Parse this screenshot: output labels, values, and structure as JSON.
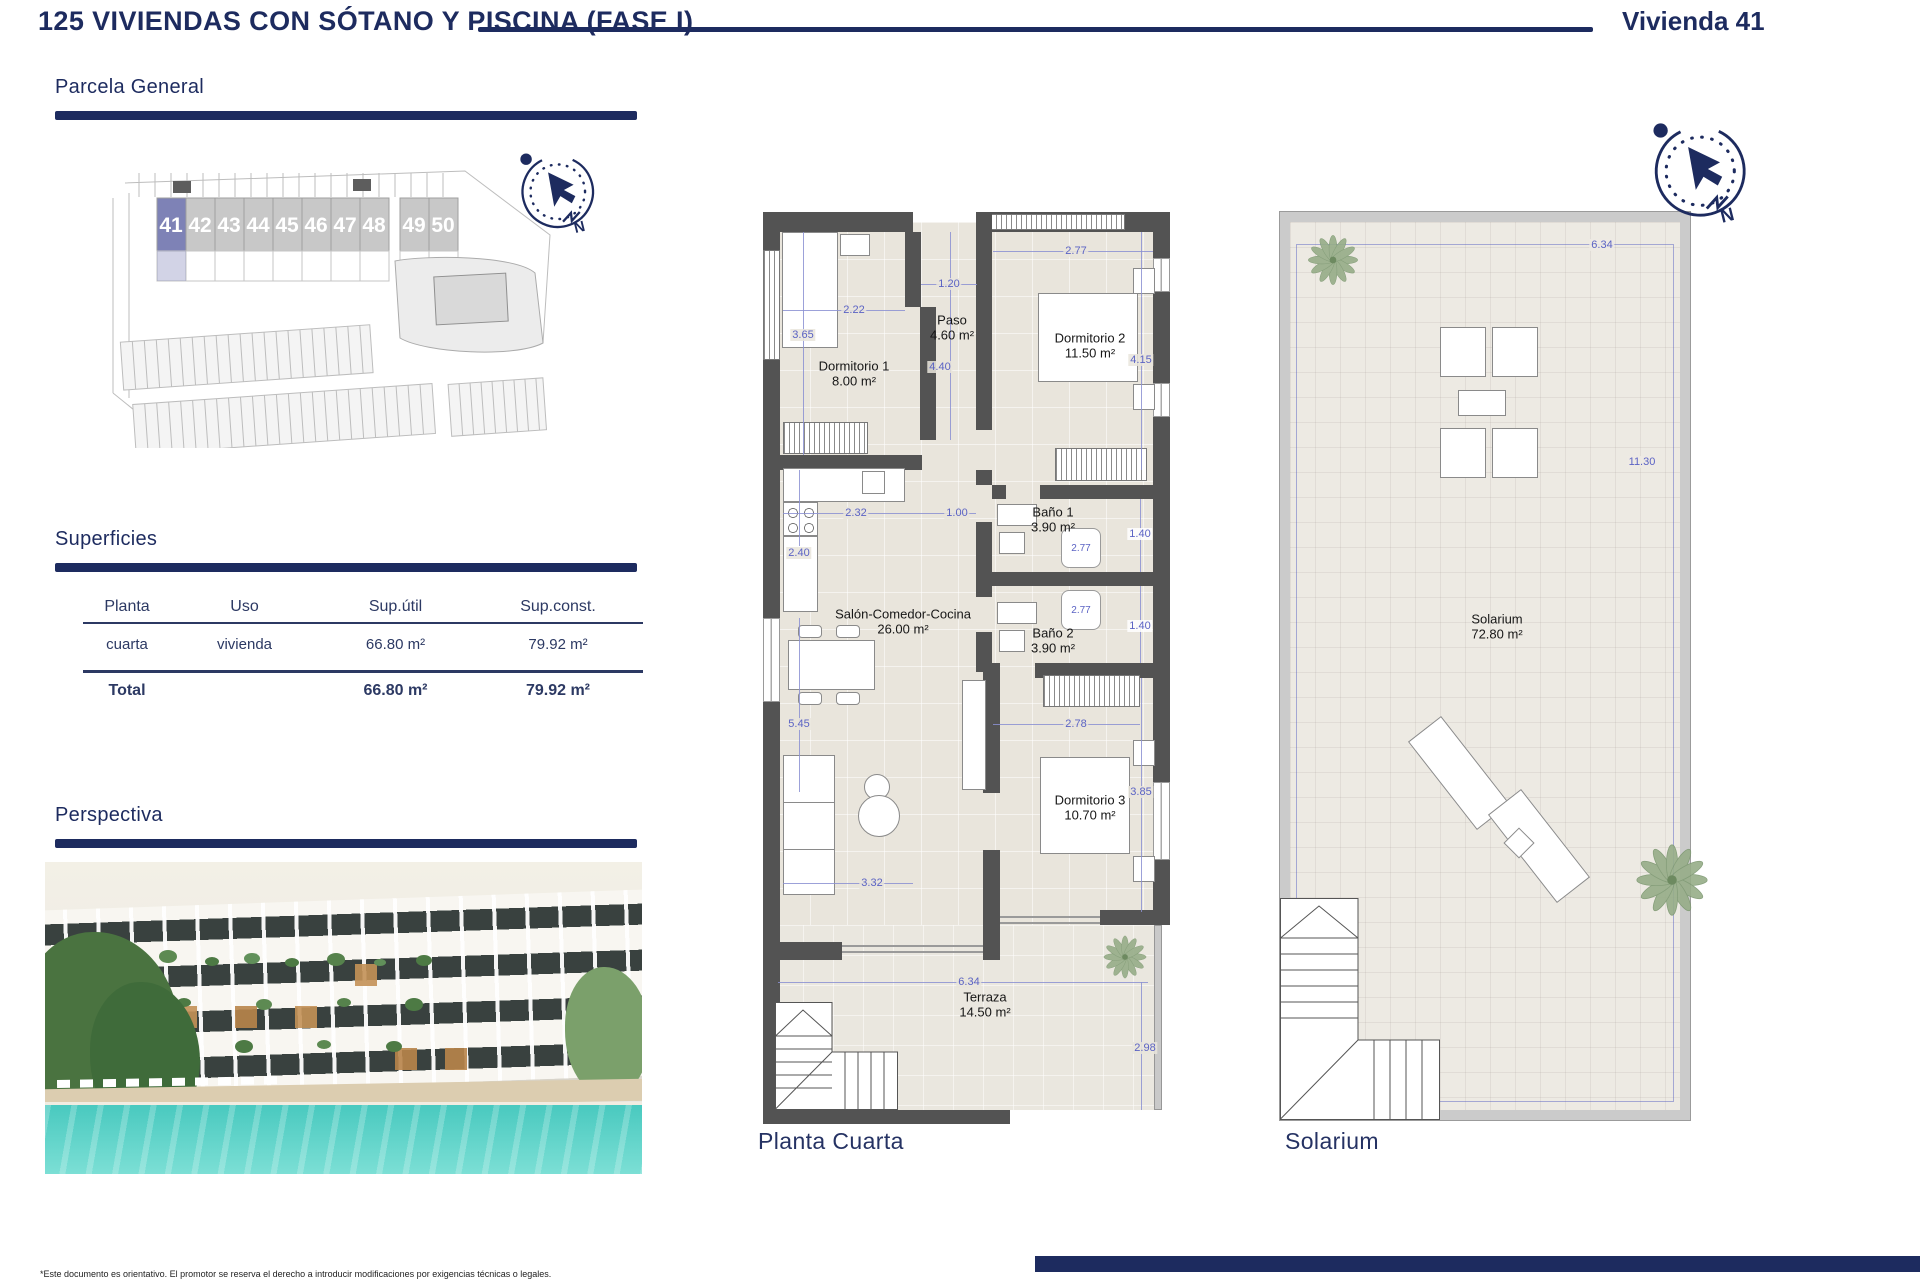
{
  "header": {
    "title": "125 VIVIENDAS CON SÓTANO Y PISCINA (FASE I)",
    "unit_label": "Vivienda 41"
  },
  "sections": {
    "parcela": "Parcela General",
    "superficies": "Superficies",
    "perspectiva": "Perspectiva"
  },
  "siteplan": {
    "units": [
      "41",
      "42",
      "43",
      "44",
      "45",
      "46",
      "47",
      "48",
      "49",
      "50"
    ],
    "highlighted": "41",
    "highlight_color": "#7e82b6"
  },
  "compass": {
    "north": "N"
  },
  "table": {
    "headers": [
      "Planta",
      "Uso",
      "Sup.útil",
      "Sup.const."
    ],
    "row": {
      "planta": "cuarta",
      "uso": "vivienda",
      "util": "66.80 m²",
      "const": "79.92 m²"
    },
    "total": {
      "label": "Total",
      "util": "66.80 m²",
      "const": "79.92 m²"
    }
  },
  "floorplan": {
    "caption": "Planta Cuarta",
    "rooms": {
      "dorm1": {
        "name": "Dormitorio 1",
        "area": "8.00 m²"
      },
      "paso": {
        "name": "Paso",
        "area": "4.60 m²"
      },
      "dorm2": {
        "name": "Dormitorio 2",
        "area": "11.50 m²"
      },
      "bano1": {
        "name": "Baño 1",
        "area": "3.90 m²"
      },
      "bano2": {
        "name": "Baño 2",
        "area": "3.90 m²"
      },
      "salon": {
        "name": "Salón-Comedor-Cocina",
        "area": "26.00 m²"
      },
      "dorm3": {
        "name": "Dormitorio 3",
        "area": "10.70 m²"
      },
      "terraza": {
        "name": "Terraza",
        "area": "14.50 m²"
      }
    },
    "dims": {
      "d365": "3.65",
      "d222": "2.22",
      "d120": "1.20",
      "d440": "4.40",
      "d277a": "2.77",
      "d415": "4.15",
      "d232": "2.32",
      "d100": "1.00",
      "d240": "2.40",
      "d140a": "1.40",
      "d277b": "2.77",
      "d277c": "2.77",
      "d140b": "1.40",
      "d545": "5.45",
      "d278": "2.78",
      "d385": "3.85",
      "d332": "3.32",
      "d634": "6.34",
      "d298": "2.98"
    }
  },
  "solarium": {
    "caption": "Solarium",
    "room": {
      "name": "Solarium",
      "area": "72.80 m²"
    },
    "dims": {
      "top": "6.34",
      "right": "11.30"
    }
  },
  "footer": {
    "note": "*Este documento es orientativo. El promotor se reserva el derecho a introducir modificaciones por exigencias técnicas o legales."
  },
  "colors": {
    "navy": "#1d2b5f",
    "dim_blue": "#5b63c4",
    "wall": "#535353",
    "pool": "#49c9bf"
  }
}
